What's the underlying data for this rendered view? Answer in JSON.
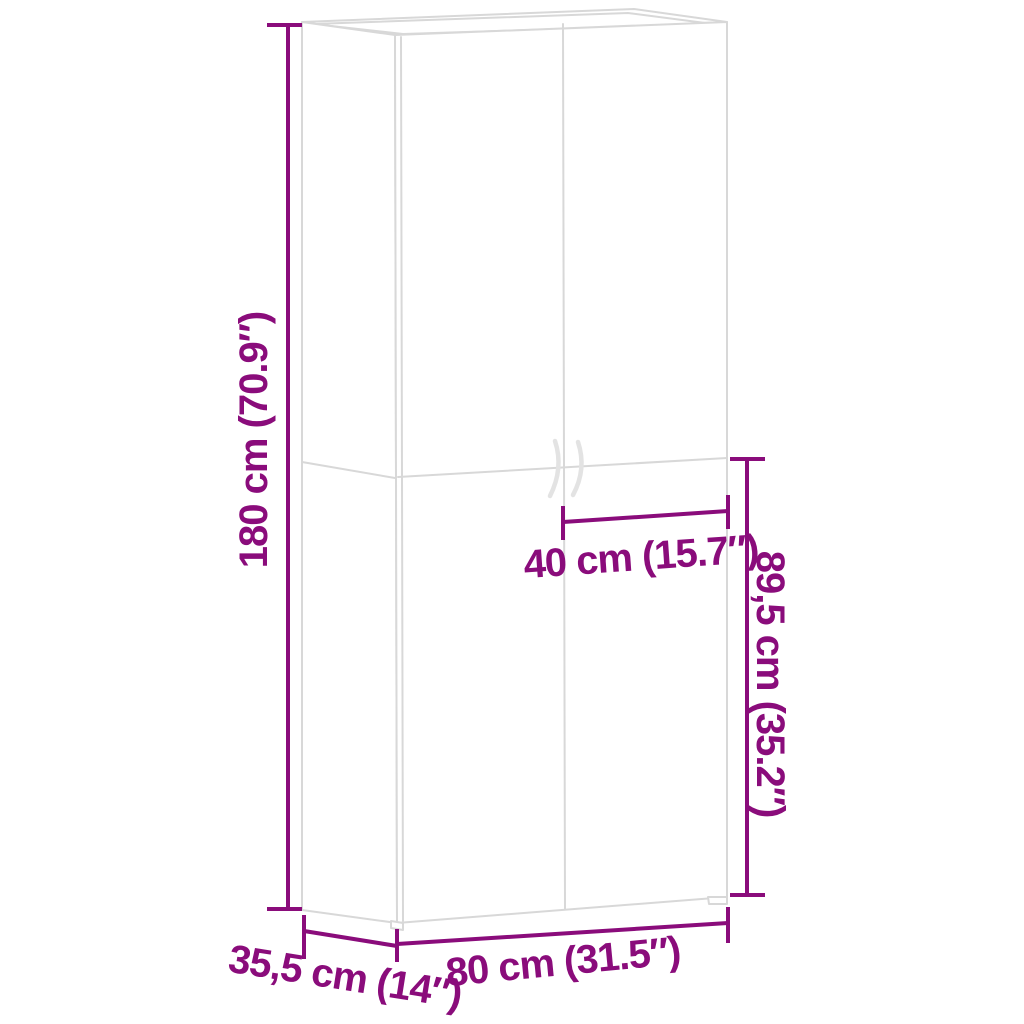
{
  "page": {
    "background": "#ffffff"
  },
  "colors": {
    "dimension": "#8a0c7b",
    "cabinet_line": "#d8d8d8",
    "handle_line": "#e3e3e3"
  },
  "diagram": {
    "subject": "two-door tall cabinet line drawing with dimension annotations",
    "dimensions": {
      "height": {
        "label": "180 cm (70.9″)",
        "position": "left",
        "orientation": "vertical"
      },
      "door_width": {
        "label": "40 cm (15.7″)",
        "position": "middle-right",
        "orientation": "horizontal"
      },
      "lower_section_height": {
        "label": "89,5 cm (35.2″)",
        "position": "right",
        "orientation": "vertical"
      },
      "width": {
        "label": "80 cm (31.5″)",
        "position": "bottom",
        "orientation": "horizontal"
      },
      "depth": {
        "label": "35,5 cm (14″)",
        "position": "bottom-left",
        "orientation": "horizontal"
      }
    }
  }
}
